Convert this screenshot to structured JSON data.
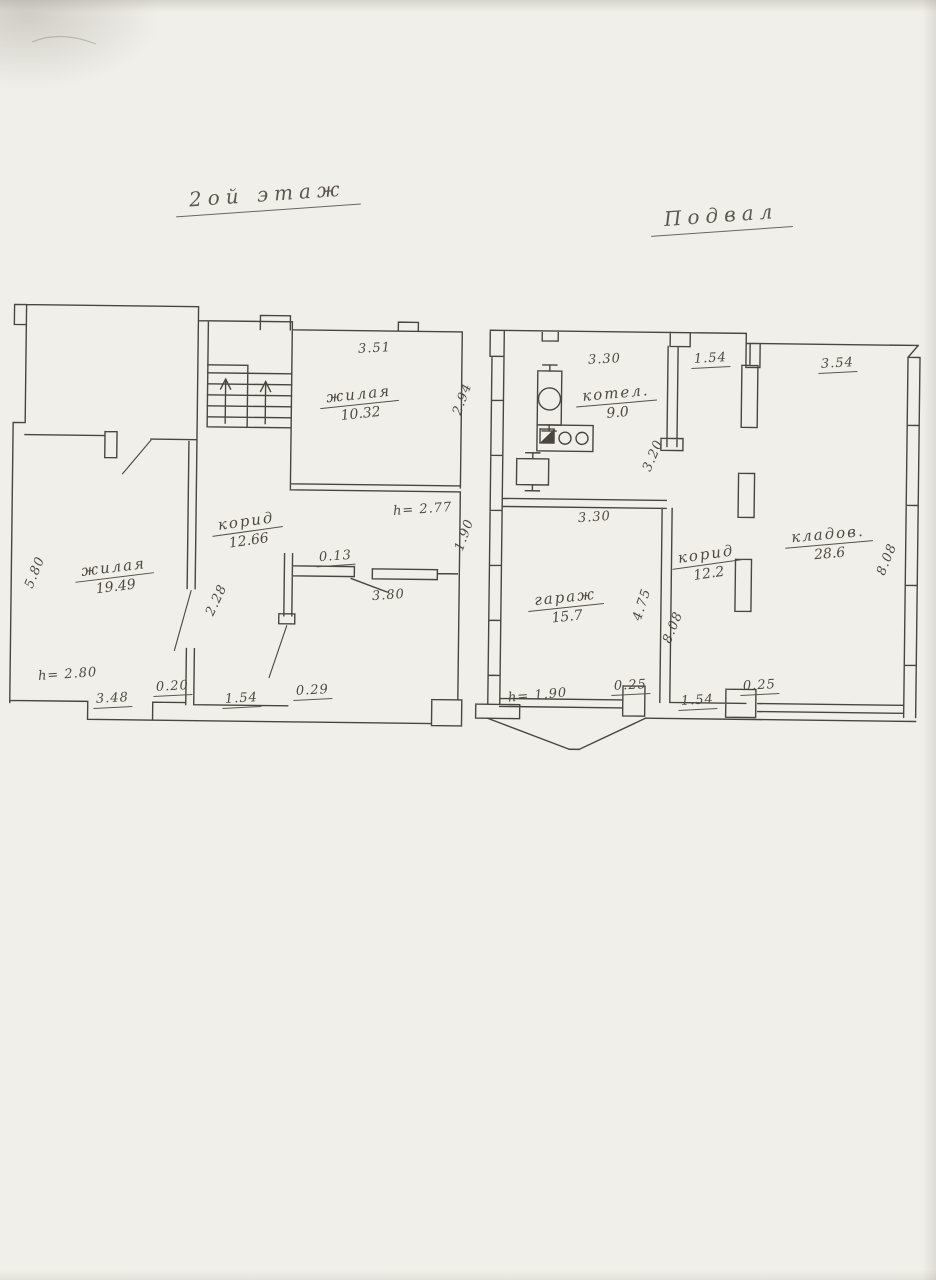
{
  "page": {
    "background": "#f1efe9",
    "ink": "#4a463e",
    "document_kind": "hand-drawn floor plan scan"
  },
  "plans": {
    "second_floor": {
      "title": "2ой этаж",
      "rooms": {
        "living_top": {
          "name": "жилая",
          "area": "10.32"
        },
        "living_left": {
          "name": "жилая",
          "area": "19.49"
        },
        "corridor": {
          "name": "корид",
          "area": "12.66"
        }
      },
      "dims": {
        "living_top_width": "3.51",
        "living_top_height": "2.94",
        "left_wall": "5.80",
        "corridor_wall": "2.28",
        "ceiling_upper": "h= 2.77",
        "right_edge": "1.90",
        "sill": "0.13",
        "opening": "3.80",
        "ceiling_lower": "h= 2.80",
        "bottom": [
          "3.48",
          "0.20",
          "1.54",
          "0.29"
        ]
      }
    },
    "basement": {
      "title": "Подвал",
      "rooms": {
        "boiler": {
          "name": "котел.",
          "area": "9.0"
        },
        "storage": {
          "name": "кладов.",
          "area": "28.6"
        },
        "garage": {
          "name": "гараж",
          "area": "15.7"
        },
        "corridor": {
          "name": "корид",
          "area": "12.2"
        }
      },
      "dims": {
        "boiler_top": "3.30",
        "top_gap": "1.54",
        "storage_top": "3.54",
        "boiler_right": "3.20",
        "storage_right": "8.08",
        "garage_top": "3.30",
        "garage_right": "4.75",
        "corridor_left": "8.08",
        "ceiling": "h= 1.90",
        "bottom_left": "0.25",
        "bottom_center": "1.54",
        "bottom_right": "0.25"
      }
    }
  }
}
